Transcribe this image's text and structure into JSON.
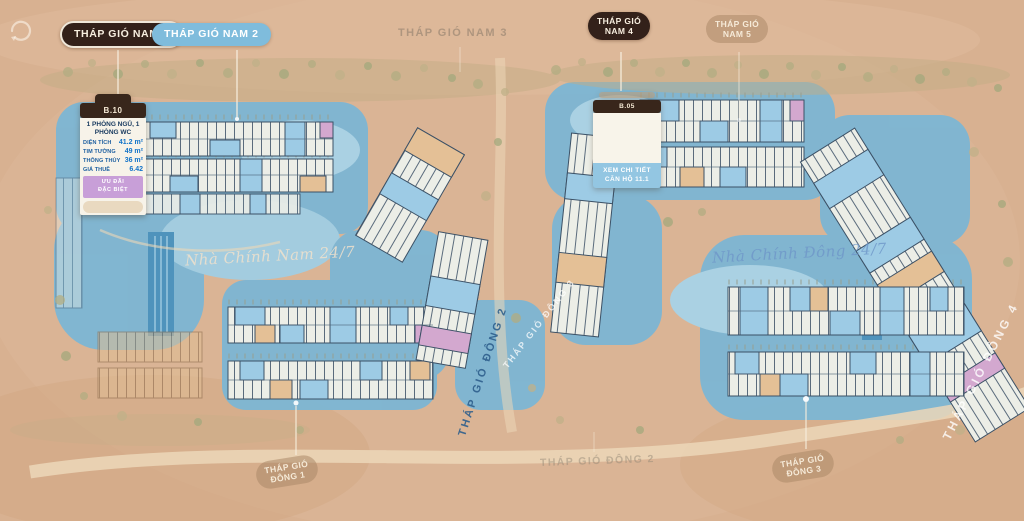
{
  "map": {
    "region_labels": {
      "nam1": "THÁP GIÓ NAM 1",
      "nam2": "THÁP GIÓ NAM 2",
      "nam3": "THÁP GIÓ NAM 3",
      "nam4": {
        "line1": "THÁP GIÓ",
        "line2": "NAM 4"
      },
      "nam5": {
        "line1": "THÁP GIÓ",
        "line2": "NAM 5"
      },
      "dong1": {
        "line1": "THÁP GIÓ",
        "line2": "ĐÔNG 1"
      },
      "dong2": "THÁP GIÓ ĐÔNG 2",
      "dong3": {
        "line1": "THÁP GIÓ",
        "line2": "ĐÔNG 3"
      }
    },
    "watermarks": {
      "script_south": "Nhà Chính Nam 24/7",
      "script_east": "Nhà Chính Đông 24/7",
      "diagonal_dark": "THÁP GIÓ ĐÔNG 2",
      "diagonal_light": "THÁP GIÓ ĐÔNG 3",
      "diagonal_right": "THÁP GIÓ ĐÔNG 4"
    }
  },
  "unit_tooltip": {
    "code": "B.10",
    "type_line1": "1 PHÒNG NGỦ, 1",
    "type_line2": "PHÒNG WC",
    "rows": [
      {
        "label": "DIỆN TÍCH",
        "value": "41.2 m²"
      },
      {
        "label": "TIM TƯỜNG",
        "value": "49 m²"
      },
      {
        "label": "THÔNG THỦY",
        "value": "36 m²"
      },
      {
        "label": "GIÁ THUÊ",
        "value": "6.42"
      }
    ],
    "promo_line1": "ƯU ĐÃI",
    "promo_line2": "ĐẶC BIỆT"
  },
  "detail_card": {
    "code": "B.05",
    "button_line1": "XEM CHI TIẾT",
    "button_line2": "CĂN HỘ 11.1"
  },
  "colors": {
    "background": "#d8b191",
    "water": "#7ab6d6",
    "pill_dark": "#33211a",
    "pill_blue": "#7fbcdc",
    "unit_blue": "#9dcbe5",
    "unit_tan": "#e4c096",
    "unit_pink": "#d3a8cf"
  }
}
